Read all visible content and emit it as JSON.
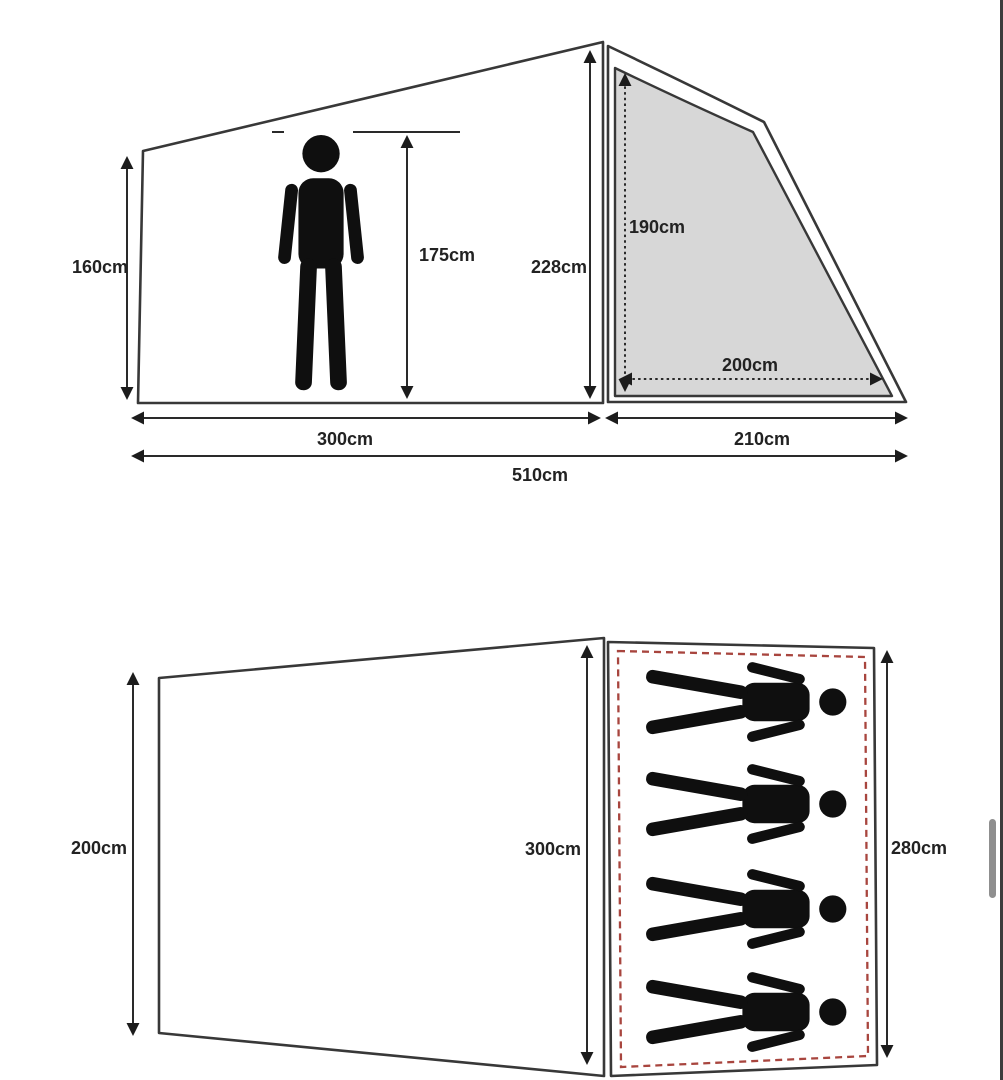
{
  "page": {
    "background": "#ffffff"
  },
  "colors": {
    "line": "#383838",
    "panel_fill": "#d7d7d7",
    "red_dashed": "#a8453e",
    "figure": "#0f0f0f",
    "label_text": "#222222",
    "scrollbar_thumb": "#8f8f8f",
    "right_border": "#3c3c3c"
  },
  "icons": {
    "standing_person": "standing-person-icon",
    "sleeping_person": "sleeping-person-icon",
    "dimension_arrow": "double-headed-arrow"
  },
  "side_view": {
    "labels": {
      "left_wall_height": "160cm",
      "person_height": "175cm",
      "peak_height": "228cm",
      "rear_inner_height": "190cm",
      "rear_inner_width": "200cm",
      "front_length": "300cm",
      "rear_length": "210cm",
      "total_length": "510cm"
    }
  },
  "floor_view": {
    "sleeper_count": 4,
    "labels": {
      "outer_width": "200cm",
      "inner_length": "300cm",
      "inner_width": "280cm"
    }
  },
  "scrollbar": {
    "orientation": "vertical"
  }
}
